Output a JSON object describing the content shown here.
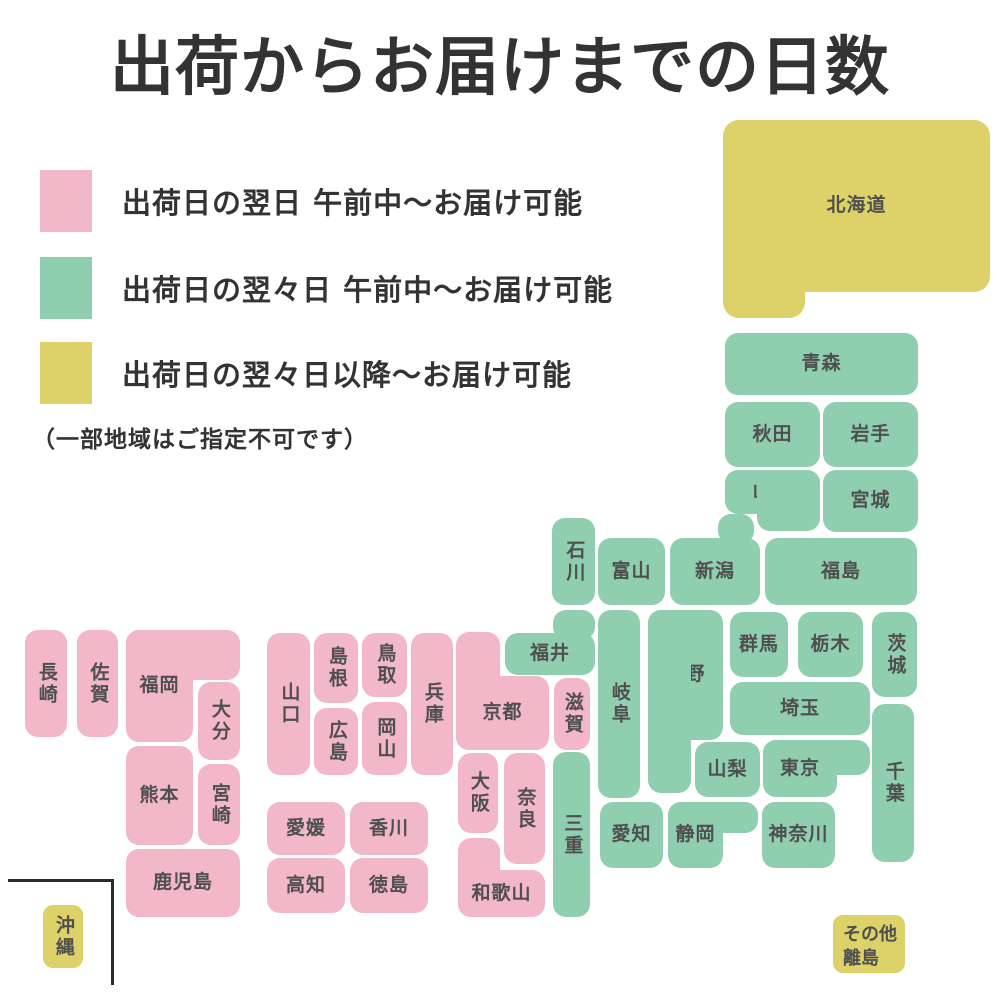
{
  "title": "出荷からお届けまでの日数",
  "colors": {
    "pink": "#F2B7C8",
    "green": "#90CEB0",
    "yellow": "#DDD169",
    "label_text": "#4f4f4f",
    "title_text": "#333333",
    "frame": "#2b2b2b"
  },
  "legend": {
    "items": [
      {
        "color": "pink",
        "label": "出荷日の翌日 午前中〜お届け可能"
      },
      {
        "color": "green",
        "label": "出荷日の翌々日 午前中〜お届け可能"
      },
      {
        "color": "yellow",
        "label": "出荷日の翌々日以降〜お届け可能"
      }
    ],
    "note": "（一部地域はご指定不可です）"
  },
  "map": {
    "prefectures": [
      {
        "id": "hokkaido",
        "name": "北海道",
        "color": "yellow",
        "rects": [
          [
            723,
            120,
            267,
            172
          ],
          [
            723,
            235,
            82,
            83
          ]
        ],
        "label_rect": 0,
        "radius": 16
      },
      {
        "id": "aomori",
        "name": "青森",
        "color": "green",
        "rects": [
          [
            725,
            333,
            193,
            62
          ]
        ]
      },
      {
        "id": "akita",
        "name": "秋田",
        "color": "green",
        "rects": [
          [
            725,
            402,
            95,
            65
          ]
        ]
      },
      {
        "id": "iwate",
        "name": "岩手",
        "color": "green",
        "rects": [
          [
            823,
            402,
            95,
            65
          ]
        ]
      },
      {
        "id": "yamagata",
        "name": "山形",
        "color": "green",
        "rects": [
          [
            725,
            470,
            95,
            44
          ],
          [
            757,
            470,
            63,
            61
          ]
        ],
        "label_rect": 0
      },
      {
        "id": "miyagi",
        "name": "宮城",
        "color": "green",
        "rects": [
          [
            823,
            470,
            95,
            62
          ]
        ]
      },
      {
        "id": "niigata",
        "name": "新潟",
        "color": "green",
        "rects": [
          [
            670,
            538,
            90,
            67
          ],
          [
            718,
            514,
            36,
            30
          ]
        ],
        "label_rect": 0
      },
      {
        "id": "fukushima",
        "name": "福島",
        "color": "green",
        "rects": [
          [
            765,
            538,
            152,
            67
          ]
        ]
      },
      {
        "id": "toyama",
        "name": "富山",
        "color": "green",
        "rects": [
          [
            598,
            538,
            67,
            67
          ]
        ]
      },
      {
        "id": "ishikawa",
        "name": "石川",
        "color": "green",
        "vertical": true,
        "rects": [
          [
            552,
            518,
            43,
            87
          ]
        ]
      },
      {
        "id": "gunma",
        "name": "群馬",
        "color": "green",
        "rects": [
          [
            730,
            612,
            58,
            65
          ]
        ]
      },
      {
        "id": "tochigi",
        "name": "栃木",
        "color": "green",
        "rects": [
          [
            798,
            612,
            65,
            65
          ]
        ]
      },
      {
        "id": "ibaraki",
        "name": "茨城",
        "color": "green",
        "vertical": true,
        "rects": [
          [
            872,
            612,
            45,
            85
          ]
        ]
      },
      {
        "id": "saitama",
        "name": "埼玉",
        "color": "green",
        "rects": [
          [
            730,
            682,
            140,
            53
          ]
        ]
      },
      {
        "id": "yamanashi",
        "name": "山梨",
        "color": "green",
        "rects": [
          [
            695,
            742,
            65,
            55
          ]
        ]
      },
      {
        "id": "tokyo",
        "name": "東京",
        "color": "green",
        "rects": [
          [
            763,
            740,
            107,
            35
          ],
          [
            763,
            740,
            74,
            57
          ]
        ],
        "label_rect": 1
      },
      {
        "id": "chiba",
        "name": "千葉",
        "color": "green",
        "vertical": true,
        "rects": [
          [
            872,
            704,
            42,
            158
          ]
        ]
      },
      {
        "id": "kanagawa",
        "name": "神奈川",
        "color": "green",
        "rects": [
          [
            762,
            802,
            73,
            66
          ]
        ]
      },
      {
        "id": "nagano",
        "name": "長野",
        "color": "green",
        "rects": [
          [
            648,
            610,
            75,
            130
          ],
          [
            648,
            610,
            43,
            183
          ]
        ],
        "label_rect": 0
      },
      {
        "id": "gifu",
        "name": "岐阜",
        "color": "green",
        "vertical": true,
        "rects": [
          [
            598,
            610,
            42,
            188
          ]
        ]
      },
      {
        "id": "aichi",
        "name": "愛知",
        "color": "green",
        "rects": [
          [
            600,
            802,
            63,
            66
          ]
        ]
      },
      {
        "id": "shizuoka",
        "name": "静岡",
        "color": "green",
        "rects": [
          [
            668,
            802,
            90,
            31
          ],
          [
            668,
            802,
            55,
            66
          ]
        ],
        "label_rect": 1
      },
      {
        "id": "fukui",
        "name": "福井",
        "color": "green",
        "rects": [
          [
            505,
            633,
            90,
            42
          ],
          [
            553,
            610,
            42,
            30
          ]
        ],
        "label_rect": 0
      },
      {
        "id": "mie",
        "name": "三重",
        "color": "green",
        "vertical": true,
        "rects": [
          [
            553,
            752,
            37,
            165
          ]
        ]
      },
      {
        "id": "shiga",
        "name": "滋賀",
        "color": "pink",
        "vertical": true,
        "rects": [
          [
            554,
            678,
            36,
            72
          ]
        ]
      },
      {
        "id": "kyoto",
        "name": "京都",
        "color": "pink",
        "rects": [
          [
            456,
            632,
            44,
            118
          ],
          [
            456,
            676,
            93,
            74
          ]
        ],
        "label_rect": 1
      },
      {
        "id": "osaka",
        "name": "大阪",
        "color": "pink",
        "vertical": true,
        "rects": [
          [
            458,
            753,
            40,
            80
          ]
        ]
      },
      {
        "id": "nara",
        "name": "奈良",
        "color": "pink",
        "vertical": true,
        "rects": [
          [
            504,
            753,
            41,
            111
          ]
        ]
      },
      {
        "id": "wakayama",
        "name": "和歌山",
        "color": "pink",
        "rects": [
          [
            458,
            838,
            42,
            79
          ],
          [
            458,
            870,
            87,
            47
          ]
        ],
        "label_rect": 1
      },
      {
        "id": "hyogo",
        "name": "兵庫",
        "color": "pink",
        "vertical": true,
        "rects": [
          [
            411,
            633,
            42,
            142
          ]
        ]
      },
      {
        "id": "tottori",
        "name": "鳥取",
        "color": "pink",
        "vertical": true,
        "rects": [
          [
            362,
            633,
            45,
            64
          ]
        ]
      },
      {
        "id": "okayama",
        "name": "岡山",
        "color": "pink",
        "vertical": true,
        "rects": [
          [
            362,
            702,
            45,
            73
          ]
        ]
      },
      {
        "id": "shimane",
        "name": "島根",
        "color": "pink",
        "vertical": true,
        "rects": [
          [
            314,
            633,
            44,
            70
          ]
        ]
      },
      {
        "id": "hiroshima",
        "name": "広島",
        "color": "pink",
        "vertical": true,
        "rects": [
          [
            314,
            708,
            44,
            67
          ]
        ]
      },
      {
        "id": "yamaguchi",
        "name": "山口",
        "color": "pink",
        "vertical": true,
        "rects": [
          [
            267,
            633,
            43,
            142
          ]
        ]
      },
      {
        "id": "ehime",
        "name": "愛媛",
        "color": "pink",
        "rects": [
          [
            267,
            802,
            78,
            53
          ]
        ]
      },
      {
        "id": "kagawa",
        "name": "香川",
        "color": "pink",
        "rects": [
          [
            350,
            802,
            78,
            53
          ]
        ]
      },
      {
        "id": "kochi",
        "name": "高知",
        "color": "pink",
        "rects": [
          [
            267,
            858,
            78,
            55
          ]
        ]
      },
      {
        "id": "tokushima",
        "name": "徳島",
        "color": "pink",
        "rects": [
          [
            350,
            858,
            78,
            55
          ]
        ]
      },
      {
        "id": "nagasaki",
        "name": "長崎",
        "color": "pink",
        "vertical": true,
        "rects": [
          [
            25,
            630,
            42,
            107
          ]
        ]
      },
      {
        "id": "saga",
        "name": "佐賀",
        "color": "pink",
        "vertical": true,
        "rects": [
          [
            77,
            630,
            41,
            107
          ]
        ]
      },
      {
        "id": "fukuoka",
        "name": "福岡",
        "color": "pink",
        "rects": [
          [
            126,
            630,
            114,
            50
          ],
          [
            126,
            630,
            67,
            112
          ]
        ],
        "label_rect": 1
      },
      {
        "id": "oita",
        "name": "大分",
        "color": "pink",
        "vertical": true,
        "rects": [
          [
            198,
            682,
            42,
            78
          ]
        ]
      },
      {
        "id": "kumamoto",
        "name": "熊本",
        "color": "pink",
        "rects": [
          [
            126,
            746,
            67,
            99
          ]
        ]
      },
      {
        "id": "miyazaki",
        "name": "宮崎",
        "color": "pink",
        "vertical": true,
        "rects": [
          [
            198,
            764,
            42,
            81
          ]
        ]
      },
      {
        "id": "kagoshima",
        "name": "鹿児島",
        "color": "pink",
        "rects": [
          [
            126,
            849,
            114,
            68
          ]
        ]
      },
      {
        "id": "okinawa",
        "name": "沖縄",
        "color": "yellow",
        "vertical": true,
        "rects": [
          [
            43,
            905,
            40,
            63
          ]
        ],
        "radius": 10
      },
      {
        "id": "other-islands",
        "name": "その他\n離島",
        "color": "yellow",
        "align": "topleft",
        "rects": [
          [
            833,
            915,
            72,
            58
          ]
        ],
        "radius": 10
      }
    ]
  }
}
